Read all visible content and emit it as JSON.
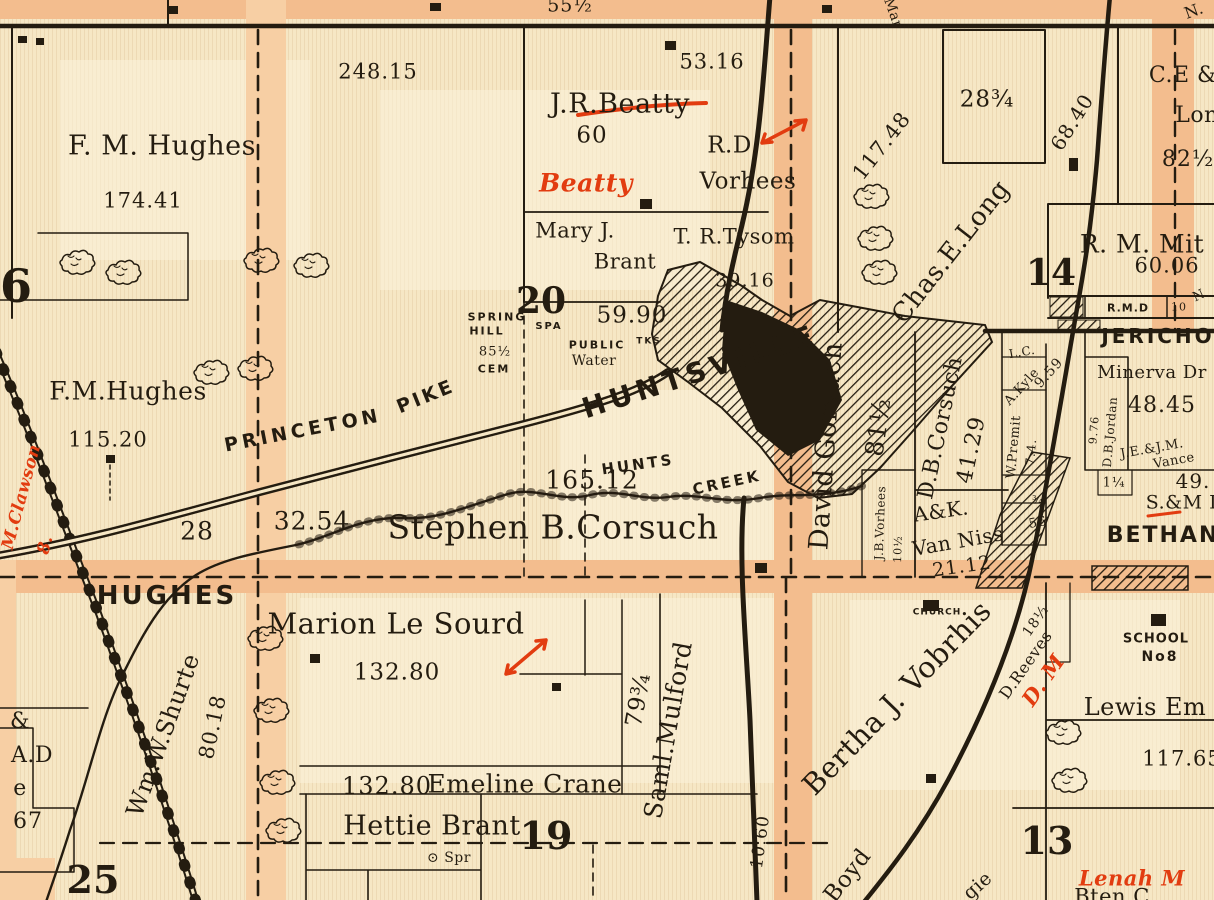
{
  "colors": {
    "paper": "#f6e7c5",
    "paper_light": "#fbf2da",
    "road": "#f3bd8e",
    "road_light": "#f7cfa4",
    "ink": "#241c10",
    "red": "#e23c10"
  },
  "map": {
    "kind": "county-plat-map-detail",
    "place_names": [
      "HUNTSVILLE",
      "JERICHO",
      "BETHANY",
      "HUGHES",
      "PRINCETON PIKE",
      "HUNTS CREEK",
      "SPRING HILL",
      "CHURCH",
      "SCHOOL No8",
      "PUBLIC WATER",
      "CEM",
      "SPA",
      "SPR"
    ],
    "section_numbers": [
      "6",
      "14",
      "20",
      "19",
      "13",
      "25"
    ],
    "labels": [
      {
        "text": "55½",
        "x": 570,
        "y": 6,
        "size": 19,
        "cls": "num"
      },
      {
        "text": "Mar",
        "x": 893,
        "y": 13,
        "rot": 70,
        "size": 14,
        "cls": "hand"
      },
      {
        "text": "N.",
        "x": 1194,
        "y": 11,
        "rot": -20,
        "size": 16,
        "cls": "hand"
      },
      {
        "text": "248.15",
        "x": 378,
        "y": 72,
        "size": 21,
        "cls": "num"
      },
      {
        "text": "53.16",
        "x": 712,
        "y": 62,
        "size": 21,
        "cls": "num"
      },
      {
        "text": "J.R.Beatty",
        "x": 620,
        "y": 104,
        "size": 27,
        "cls": "hand"
      },
      {
        "text": "60",
        "x": 592,
        "y": 136,
        "size": 23,
        "cls": "num"
      },
      {
        "text": "R.D.",
        "x": 733,
        "y": 146,
        "size": 23,
        "cls": "hand"
      },
      {
        "text": "Vorhees",
        "x": 748,
        "y": 182,
        "size": 23,
        "cls": "hand"
      },
      {
        "text": "Beatty",
        "x": 586,
        "y": 183,
        "size": 25,
        "cls": "hand",
        "red": true
      },
      {
        "text": "117.48",
        "x": 882,
        "y": 146,
        "rot": -52,
        "size": 21,
        "cls": "num"
      },
      {
        "text": "28¾",
        "x": 987,
        "y": 100,
        "size": 23,
        "cls": "num"
      },
      {
        "text": "68.40",
        "x": 1072,
        "y": 122,
        "rot": -58,
        "size": 20,
        "cls": "num"
      },
      {
        "text": "C.E &",
        "x": 1183,
        "y": 76,
        "size": 22,
        "cls": "hand"
      },
      {
        "text": "Lon",
        "x": 1197,
        "y": 116,
        "size": 22,
        "cls": "hand"
      },
      {
        "text": "82½",
        "x": 1188,
        "y": 160,
        "size": 22,
        "cls": "num"
      },
      {
        "text": "Mary J.",
        "x": 575,
        "y": 231,
        "size": 21,
        "cls": "hand"
      },
      {
        "text": "Brant",
        "x": 625,
        "y": 262,
        "size": 21,
        "cls": "hand"
      },
      {
        "text": "T. R.Tysom",
        "x": 734,
        "y": 237,
        "size": 21,
        "cls": "hand"
      },
      {
        "text": "39.16",
        "x": 745,
        "y": 281,
        "size": 19,
        "cls": "num"
      },
      {
        "text": "Chas.E.Long",
        "x": 951,
        "y": 252,
        "rot": -52,
        "size": 26,
        "cls": "hand"
      },
      {
        "text": "14",
        "x": 1051,
        "y": 273,
        "size": 36,
        "cls": "sec"
      },
      {
        "text": "R. M. Mit",
        "x": 1142,
        "y": 244,
        "size": 25,
        "cls": "hand"
      },
      {
        "text": "60.06",
        "x": 1167,
        "y": 266,
        "size": 21,
        "cls": "num"
      },
      {
        "text": "SPRING",
        "x": 497,
        "y": 317,
        "size": 11,
        "cls": "caps"
      },
      {
        "text": "HILL",
        "x": 487,
        "y": 331,
        "size": 11,
        "cls": "caps"
      },
      {
        "text": "SPA",
        "x": 549,
        "y": 327,
        "size": 10,
        "cls": "caps"
      },
      {
        "text": "85½",
        "x": 495,
        "y": 352,
        "size": 13,
        "cls": "num"
      },
      {
        "text": "CEM",
        "x": 494,
        "y": 369,
        "size": 11,
        "cls": "caps"
      },
      {
        "text": "20",
        "x": 541,
        "y": 301,
        "size": 36,
        "cls": "sec"
      },
      {
        "text": "59.90",
        "x": 632,
        "y": 316,
        "size": 23,
        "cls": "num"
      },
      {
        "text": "PUBLIC",
        "x": 597,
        "y": 345,
        "size": 11,
        "cls": "caps"
      },
      {
        "text": "Water",
        "x": 594,
        "y": 361,
        "size": 14,
        "cls": "hand"
      },
      {
        "text": "TKS",
        "x": 649,
        "y": 342,
        "size": 9,
        "cls": "caps"
      },
      {
        "text": "HUNTSVILLE",
        "x": 700,
        "y": 372,
        "rot": -18,
        "size": 28,
        "cls": "caps",
        "ls": 5
      },
      {
        "text": "HUNTS",
        "x": 638,
        "y": 465,
        "rot": -8,
        "size": 15,
        "cls": "caps",
        "ls": 3
      },
      {
        "text": "CREEK",
        "x": 727,
        "y": 483,
        "rot": -12,
        "size": 15,
        "cls": "caps",
        "ls": 3
      },
      {
        "text": "165.12",
        "x": 592,
        "y": 480,
        "size": 25,
        "cls": "num"
      },
      {
        "text": "Stephen B.Corsuch",
        "x": 553,
        "y": 527,
        "size": 33,
        "cls": "hand"
      },
      {
        "text": "PRINCETON",
        "x": 303,
        "y": 431,
        "rot": -11,
        "size": 19,
        "cls": "caps",
        "ls": 4
      },
      {
        "text": "PIKE",
        "x": 426,
        "y": 397,
        "rot": -22,
        "size": 19,
        "cls": "caps",
        "ls": 3
      },
      {
        "text": "F. M. Hughes",
        "x": 162,
        "y": 146,
        "size": 27,
        "cls": "hand"
      },
      {
        "text": "174.41",
        "x": 143,
        "y": 201,
        "size": 21,
        "cls": "num"
      },
      {
        "text": "F.M.Hughes",
        "x": 128,
        "y": 391,
        "size": 25,
        "cls": "hand"
      },
      {
        "text": "115.20",
        "x": 108,
        "y": 440,
        "size": 21,
        "cls": "num"
      },
      {
        "text": "6",
        "x": 16,
        "y": 286,
        "size": 46,
        "cls": "sec"
      },
      {
        "text": "M.Clawson",
        "x": 22,
        "y": 497,
        "rot": -75,
        "size": 17,
        "cls": "hand",
        "red": true
      },
      {
        "text": "8.",
        "x": 46,
        "y": 545,
        "rot": -75,
        "size": 17,
        "cls": "hand",
        "red": true
      },
      {
        "text": "28",
        "x": 197,
        "y": 531,
        "size": 25,
        "cls": "num"
      },
      {
        "text": "32.54",
        "x": 312,
        "y": 521,
        "size": 25,
        "cls": "num"
      },
      {
        "text": "HUGHES",
        "x": 167,
        "y": 596,
        "size": 26,
        "cls": "caps",
        "ls": 3
      },
      {
        "text": "David Gorsuch",
        "x": 826,
        "y": 446,
        "rot": -86,
        "size": 27,
        "cls": "hand"
      },
      {
        "text": "81½",
        "x": 878,
        "y": 427,
        "rot": -82,
        "size": 25,
        "cls": "num"
      },
      {
        "text": "J.B.Vorhees",
        "x": 880,
        "y": 523,
        "rot": -88,
        "size": 12,
        "cls": "hand"
      },
      {
        "text": "10½",
        "x": 898,
        "y": 549,
        "rot": -88,
        "size": 11,
        "cls": "num"
      },
      {
        "text": "D.B.Corsuch",
        "x": 941,
        "y": 428,
        "rot": -78,
        "size": 22,
        "cls": "hand"
      },
      {
        "text": "41.29",
        "x": 972,
        "y": 450,
        "rot": -78,
        "size": 22,
        "cls": "num"
      },
      {
        "text": "A&K.",
        "x": 941,
        "y": 511,
        "rot": -8,
        "size": 20,
        "cls": "hand"
      },
      {
        "text": "Van Niss",
        "x": 958,
        "y": 541,
        "rot": -10,
        "size": 20,
        "cls": "hand"
      },
      {
        "text": "21.12",
        "x": 962,
        "y": 567,
        "rot": -8,
        "size": 19,
        "cls": "num"
      },
      {
        "text": "L.C.",
        "x": 1022,
        "y": 352,
        "rot": -10,
        "size": 12,
        "cls": "hand"
      },
      {
        "text": "A.Kyle",
        "x": 1022,
        "y": 387,
        "rot": -48,
        "size": 13,
        "cls": "hand"
      },
      {
        "text": "9.59",
        "x": 1049,
        "y": 373,
        "rot": -48,
        "size": 14,
        "cls": "num"
      },
      {
        "text": "W.Premit",
        "x": 1014,
        "y": 447,
        "rot": -85,
        "size": 13,
        "cls": "hand"
      },
      {
        "text": "7.4.",
        "x": 1031,
        "y": 452,
        "rot": -85,
        "size": 12,
        "cls": "num"
      },
      {
        "text": "¾",
        "x": 1038,
        "y": 500,
        "size": 11,
        "cls": "num"
      },
      {
        "text": "56",
        "x": 1038,
        "y": 523,
        "rot": -10,
        "size": 13,
        "cls": "num"
      },
      {
        "text": "9.76",
        "x": 1094,
        "y": 430,
        "rot": -85,
        "size": 11,
        "cls": "num"
      },
      {
        "text": "D.B.Jordan",
        "x": 1110,
        "y": 432,
        "rot": -85,
        "size": 12,
        "cls": "hand"
      },
      {
        "text": "R.M.D",
        "x": 1128,
        "y": 308,
        "size": 11,
        "cls": "caps",
        "ls": 1
      },
      {
        "text": "10",
        "x": 1179,
        "y": 307,
        "size": 11,
        "cls": "num"
      },
      {
        "text": "N",
        "x": 1199,
        "y": 296,
        "rot": -25,
        "size": 13,
        "cls": "hand"
      },
      {
        "text": "JERICHO",
        "x": 1158,
        "y": 336,
        "size": 20,
        "cls": "caps",
        "ls": 3
      },
      {
        "text": "Minerva Dr",
        "x": 1152,
        "y": 373,
        "size": 18,
        "cls": "hand"
      },
      {
        "text": "48.45",
        "x": 1162,
        "y": 406,
        "size": 22,
        "cls": "num"
      },
      {
        "text": "J.E.&J.M.",
        "x": 1152,
        "y": 449,
        "rot": -10,
        "size": 13,
        "cls": "hand"
      },
      {
        "text": "Vance",
        "x": 1174,
        "y": 461,
        "rot": -10,
        "size": 13,
        "cls": "hand"
      },
      {
        "text": "1¼",
        "x": 1114,
        "y": 483,
        "size": 13,
        "cls": "num"
      },
      {
        "text": "49.",
        "x": 1193,
        "y": 481,
        "size": 20,
        "cls": "num"
      },
      {
        "text": "S.&M L",
        "x": 1184,
        "y": 503,
        "size": 19,
        "cls": "hand"
      },
      {
        "text": "BETHANY",
        "x": 1172,
        "y": 536,
        "size": 22,
        "cls": "caps",
        "ls": 2
      },
      {
        "text": "CHURCH",
        "x": 937,
        "y": 613,
        "size": 9,
        "cls": "caps",
        "ls": 1
      },
      {
        "text": "Bertha J. Vobrhis",
        "x": 897,
        "y": 698,
        "rot": -46,
        "size": 29,
        "cls": "hand"
      },
      {
        "text": "D.Reeves",
        "x": 1026,
        "y": 665,
        "rot": -55,
        "size": 16,
        "cls": "hand"
      },
      {
        "text": "18½",
        "x": 1036,
        "y": 621,
        "rot": -55,
        "size": 14,
        "cls": "num"
      },
      {
        "text": "D. M",
        "x": 1043,
        "y": 680,
        "rot": -55,
        "size": 21,
        "cls": "hand",
        "red": true
      },
      {
        "text": "SCHOOL",
        "x": 1156,
        "y": 639,
        "size": 13,
        "cls": "caps",
        "ls": 1
      },
      {
        "text": "No8",
        "x": 1160,
        "y": 657,
        "size": 14,
        "cls": "caps"
      },
      {
        "text": "Lewis Em",
        "x": 1145,
        "y": 707,
        "size": 24,
        "cls": "hand"
      },
      {
        "text": "117.65",
        "x": 1182,
        "y": 759,
        "size": 21,
        "cls": "num"
      },
      {
        "text": "13",
        "x": 1047,
        "y": 841,
        "size": 38,
        "cls": "sec"
      },
      {
        "text": "Lenah M",
        "x": 1132,
        "y": 878,
        "size": 21,
        "cls": "hand",
        "red": true
      },
      {
        "text": "Bten C",
        "x": 1112,
        "y": 897,
        "size": 21,
        "cls": "hand"
      },
      {
        "text": "Boyd",
        "x": 848,
        "y": 876,
        "rot": -52,
        "size": 23,
        "cls": "hand"
      },
      {
        "text": "gie",
        "x": 978,
        "y": 886,
        "rot": -42,
        "size": 19,
        "cls": "hand"
      },
      {
        "text": "10.60",
        "x": 761,
        "y": 842,
        "rot": -82,
        "size": 17,
        "cls": "num"
      },
      {
        "text": "Saml.Mulford",
        "x": 668,
        "y": 730,
        "rot": -80,
        "size": 25,
        "cls": "hand"
      },
      {
        "text": "79¾",
        "x": 639,
        "y": 700,
        "rot": -80,
        "size": 23,
        "cls": "num"
      },
      {
        "text": "Marion Le Sourd",
        "x": 396,
        "y": 624,
        "size": 29,
        "cls": "hand"
      },
      {
        "text": "132.80",
        "x": 397,
        "y": 673,
        "size": 23,
        "cls": "num"
      },
      {
        "text": "132.80",
        "x": 387,
        "y": 786,
        "size": 24,
        "cls": "num"
      },
      {
        "text": "Emeline Crane",
        "x": 525,
        "y": 784,
        "size": 25,
        "cls": "hand"
      },
      {
        "text": "Hettie Brant",
        "x": 432,
        "y": 826,
        "size": 27,
        "cls": "hand"
      },
      {
        "text": "19",
        "x": 546,
        "y": 836,
        "size": 38,
        "cls": "sec"
      },
      {
        "text": "⊙ Spr",
        "x": 449,
        "y": 858,
        "size": 14,
        "cls": "hand"
      },
      {
        "text": "Wm.W.Shurte",
        "x": 163,
        "y": 735,
        "rot": -70,
        "size": 24,
        "cls": "hand"
      },
      {
        "text": "80.18",
        "x": 213,
        "y": 727,
        "rot": -78,
        "size": 21,
        "cls": "num"
      },
      {
        "text": "&",
        "x": 20,
        "y": 722,
        "size": 22,
        "cls": "hand"
      },
      {
        "text": "A.D",
        "x": 32,
        "y": 756,
        "size": 22,
        "cls": "hand"
      },
      {
        "text": "e",
        "x": 20,
        "y": 789,
        "size": 22,
        "cls": "hand"
      },
      {
        "text": "67",
        "x": 28,
        "y": 822,
        "size": 22,
        "cls": "num"
      },
      {
        "text": "25",
        "x": 93,
        "y": 880,
        "size": 38,
        "cls": "sec"
      }
    ],
    "building_markers": [
      {
        "x": 18,
        "y": 36,
        "w": 9,
        "h": 7
      },
      {
        "x": 36,
        "y": 38,
        "w": 8,
        "h": 7
      },
      {
        "x": 168,
        "y": 6,
        "w": 10,
        "h": 8
      },
      {
        "x": 430,
        "y": 3,
        "w": 11,
        "h": 8
      },
      {
        "x": 822,
        "y": 5,
        "w": 10,
        "h": 8
      },
      {
        "x": 665,
        "y": 41,
        "w": 11,
        "h": 9
      },
      {
        "x": 640,
        "y": 199,
        "w": 12,
        "h": 10
      },
      {
        "x": 106,
        "y": 455,
        "w": 9,
        "h": 8
      },
      {
        "x": 310,
        "y": 654,
        "w": 10,
        "h": 9
      },
      {
        "x": 552,
        "y": 683,
        "w": 9,
        "h": 8
      },
      {
        "x": 755,
        "y": 563,
        "w": 12,
        "h": 10
      },
      {
        "x": 923,
        "y": 600,
        "w": 16,
        "h": 11
      },
      {
        "x": 926,
        "y": 774,
        "w": 10,
        "h": 9
      },
      {
        "x": 1151,
        "y": 614,
        "w": 15,
        "h": 12
      },
      {
        "x": 1069,
        "y": 158,
        "w": 9,
        "h": 13
      }
    ]
  }
}
